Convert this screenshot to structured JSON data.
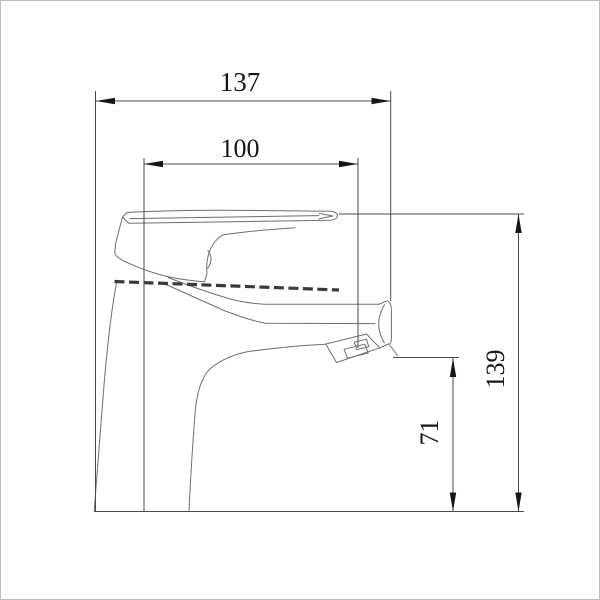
{
  "page": {
    "background": "#ffffff",
    "frame_border_color": "#bdbdbd"
  },
  "drawing": {
    "type": "technical_dimension_drawing",
    "subject": "single-lever-faucet-side-view",
    "colors": {
      "outline": "#6f6f6f",
      "dimension_lines": "#4a4a4a",
      "arrows_text": "#161616",
      "joint_hatch": "#3a3a3a"
    },
    "dimensions": [
      {
        "name": "overall-width",
        "label": "137",
        "orientation": "horizontal"
      },
      {
        "name": "spout-width",
        "label": "100",
        "orientation": "horizontal"
      },
      {
        "name": "overall-height",
        "label": "139",
        "orientation": "vertical"
      },
      {
        "name": "spout-outlet-height",
        "label": "71",
        "orientation": "vertical"
      }
    ]
  }
}
